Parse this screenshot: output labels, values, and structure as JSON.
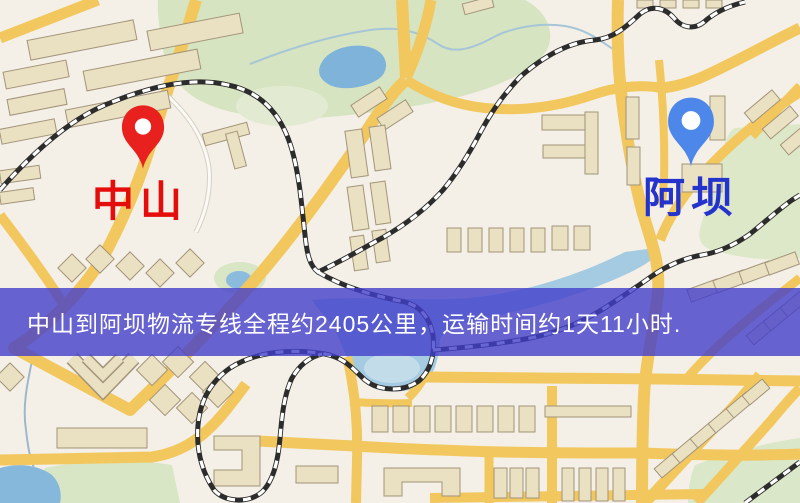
{
  "map": {
    "origin": {
      "name": "中山",
      "pin_color": "#e8201e",
      "label_color": "#e50c0c"
    },
    "destination": {
      "name": "阿坝",
      "pin_color": "#4e87ea",
      "label_color": "#2433cc"
    },
    "banner": {
      "text": "中山到阿坝物流专线全程约2405公里，运输时间约1天11小时.",
      "background": "rgba(66,63,202,0.8)",
      "text_color": "#ffffff"
    },
    "route_info": {
      "distance_km": "2405",
      "duration": "1天11小时"
    }
  }
}
